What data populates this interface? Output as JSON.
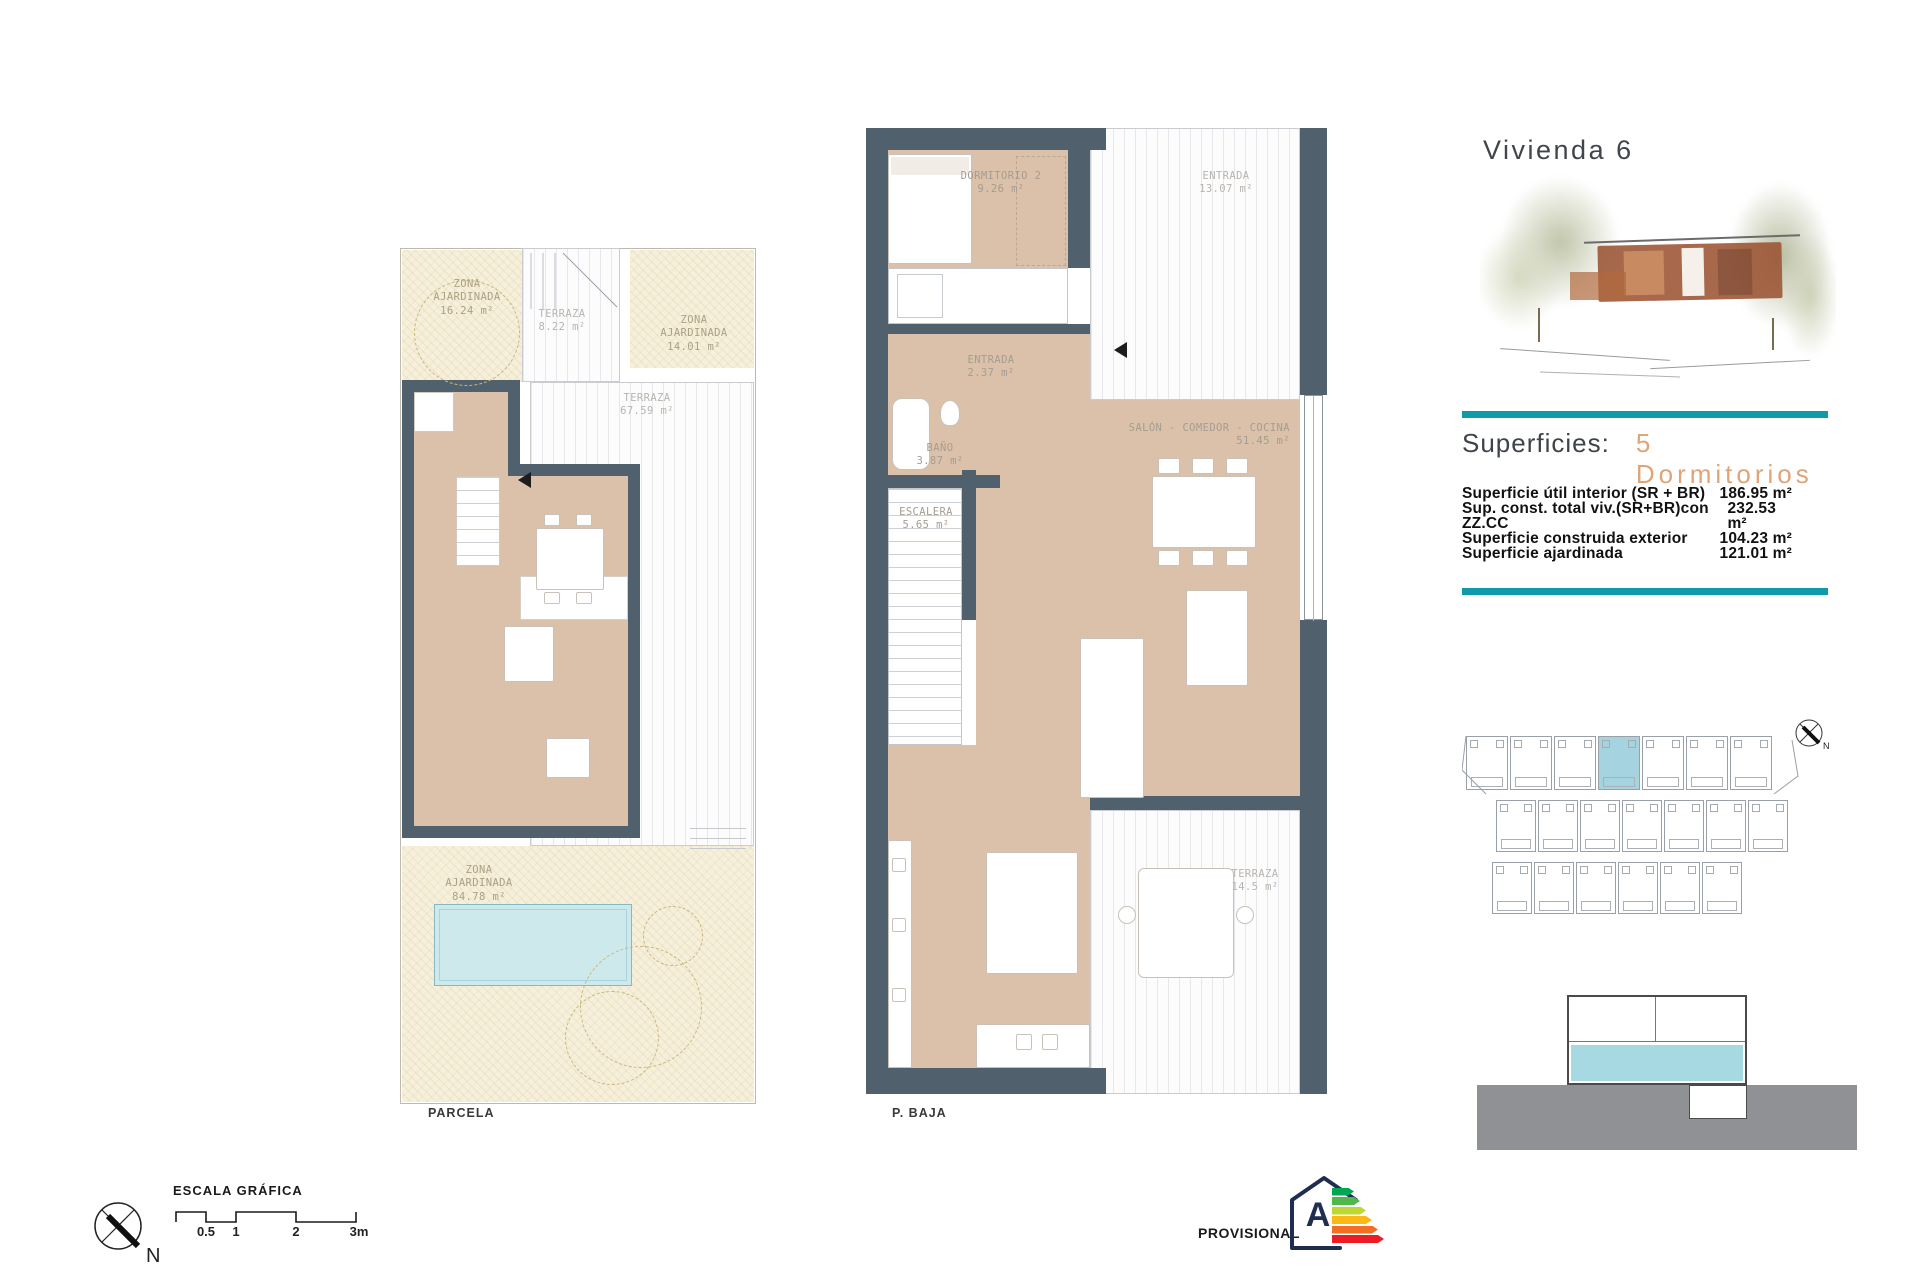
{
  "header": {
    "title": "Vivienda 6"
  },
  "superficies": {
    "heading": "Superficies:",
    "bedrooms_label": "5 Dormitorios",
    "rows": [
      {
        "label": "Superficie útil interior (SR + BR)",
        "value": "186.95 m²"
      },
      {
        "label": "Sup. const. total viv.(SR+BR)con ZZ.CC",
        "value": "232.53 m²"
      },
      {
        "label": "Superficie construida exterior",
        "value": "104.23 m²"
      },
      {
        "label": "Superficie ajardinada",
        "value": "121.01 m²"
      }
    ]
  },
  "plan_parcela": {
    "caption": "PARCELA",
    "rooms": [
      {
        "name": "ZONA\nAJARDINADA",
        "area": "16.24 m²"
      },
      {
        "name": "TERRAZA",
        "area": "8.22 m²"
      },
      {
        "name": "ZONA\nAJARDINADA",
        "area": "14.01 m²"
      },
      {
        "name": "TERRAZA",
        "area": "67.59 m²"
      },
      {
        "name": "ZONA\nAJARDINADA",
        "area": "84.78 m²"
      }
    ]
  },
  "plan_pbaja": {
    "caption": "P. BAJA",
    "rooms": [
      {
        "name": "DORMITORIO 2",
        "area": "9.26 m²"
      },
      {
        "name": "ENTRADA",
        "area": "13.07 m²"
      },
      {
        "name": "ENTRADA",
        "area": "2.37 m²"
      },
      {
        "name": "BAÑO",
        "area": "3.87 m²"
      },
      {
        "name": "ESCALERA",
        "area": "5.65 m²"
      },
      {
        "name": "SALÓN - COMEDOR - COCINA",
        "area": "51.45 m²"
      },
      {
        "name": "TERRAZA",
        "area": "14.5 m²"
      }
    ]
  },
  "scale": {
    "title": "ESCALA GRÁFICA",
    "tick_labels": [
      "0.5",
      "1",
      "2",
      "3m"
    ]
  },
  "north_label": "N",
  "footer": {
    "provisional": "PROVISIONAL"
  },
  "energy": {
    "letter": "A",
    "bar_colors": [
      "#00a651",
      "#50b848",
      "#bfd730",
      "#fdb913",
      "#f37021",
      "#ed1c24"
    ]
  },
  "site_plan": {
    "rows": [
      7,
      7,
      6
    ],
    "highlight_row": 0,
    "highlight_index": 3
  },
  "colors": {
    "teal": "#0f9aa9",
    "salmon": "#dfa478",
    "wall": "#50606d",
    "floor_tan": "#dbc1a9",
    "garden_cream": "#f6efda",
    "pool_blue": "#cde9ec",
    "site_highlight": "#a6d3e0",
    "section_ground": "#8f9194",
    "section_water": "#a7d9e3"
  }
}
